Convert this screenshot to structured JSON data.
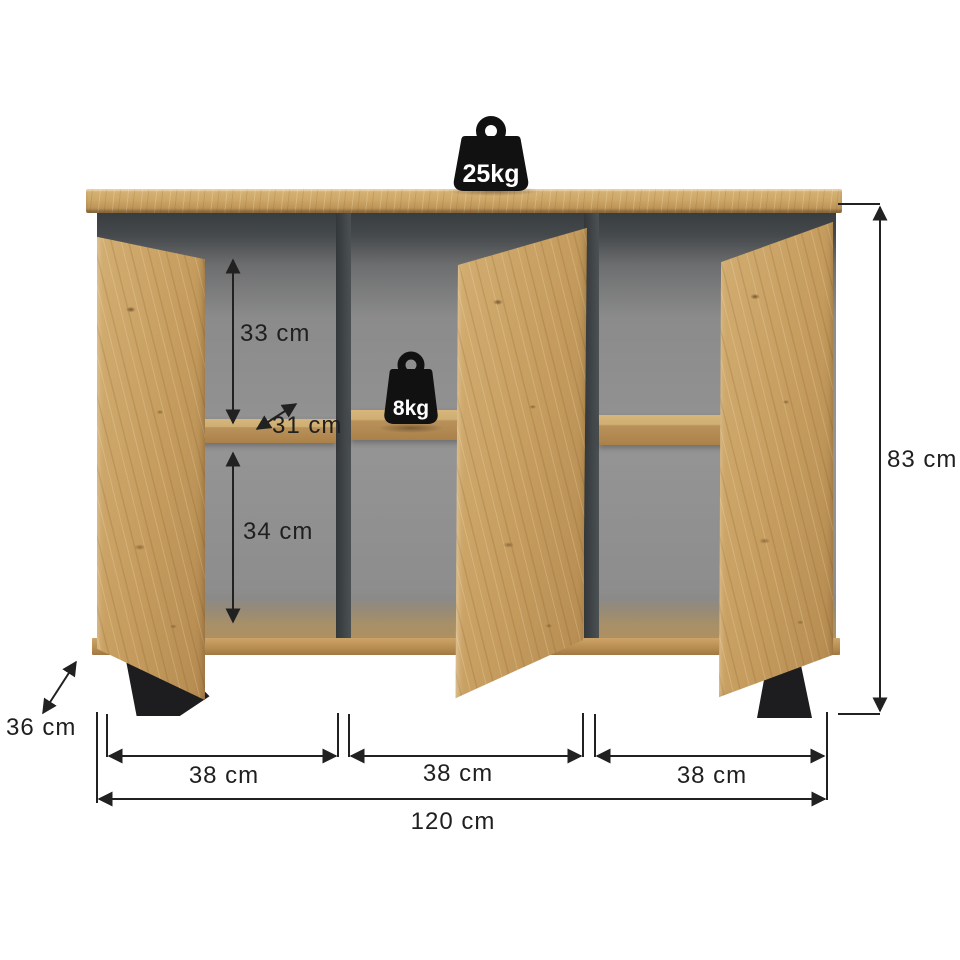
{
  "weights": {
    "top_load": "25kg",
    "shelf_load": "8kg"
  },
  "dimensions": {
    "upper_compartment_height": "33 cm",
    "shelf_depth": "31 cm",
    "lower_compartment_height": "34 cm",
    "overall_height": "83 cm",
    "overall_depth": "36 cm",
    "left_section_width": "38 cm",
    "middle_section_width": "38 cm",
    "right_section_width": "38 cm",
    "overall_width": "120 cm"
  },
  "colors": {
    "wood": "#c79e63",
    "wood_dark": "#a87f4a",
    "interior_gray": "#8d8d8d",
    "frame_anthracite": "#3d4245",
    "leg_black": "#1d1d1f",
    "dimension_line": "#212121",
    "weight_icon": "#111111",
    "weight_text": "#ffffff",
    "background": "#ffffff"
  }
}
